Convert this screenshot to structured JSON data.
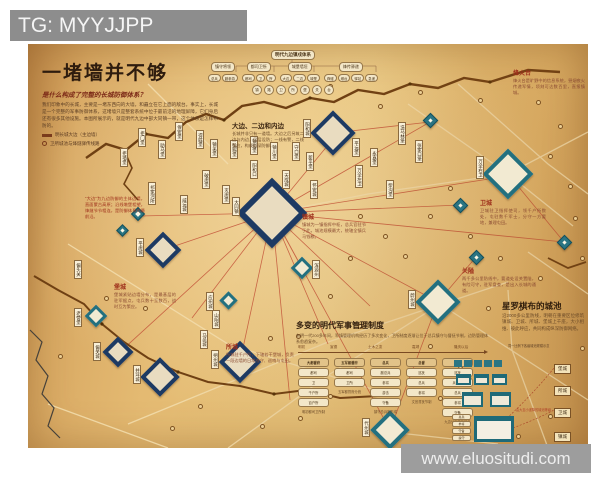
{
  "watermarks": {
    "top": "TG: MYYJJPP",
    "bottom": "www.eluositudi.com"
  },
  "header": {
    "title": "一堵墙并不够",
    "subtitle": "是什么构成了完整的长城防御体系？",
    "intro": "我们印象中的长城，主要是一堵东西向的大墙，和矗立在它上面的敌台。事实上，长城是一个完整的军事防御体系，这堵墙只是整套系统中位于最前沿的地理屏障，它们身后还有很多其他设施。本图所展示的，就是明代九边中部大同镇一带，这个体系是怎样布防的。",
    "legend": [
      {
        "icon": "wall",
        "label": "明长城大边（主边墙）"
      },
      {
        "icon": "beacon",
        "label": "卫所城池与烽燧驿传线路"
      }
    ]
  },
  "org": {
    "root": "明代九边镇戍体系",
    "groups": [
      {
        "label": "镇守将领",
        "leaves": [
          "总兵",
          "副参游"
        ]
      },
      {
        "label": "都司卫所",
        "leaves": [
          "都司",
          "卫",
          "所"
        ]
      },
      {
        "label": "城堡墙垣",
        "leaves": [
          "大边",
          "二边",
          "城堡"
        ]
      },
      {
        "label": "烽传驿递",
        "leaves": [
          "烽燧",
          "墩台",
          "驿站",
          "急递"
        ]
      }
    ],
    "circles": [
      "镇",
      "路",
      "卫",
      "所",
      "堡",
      "关",
      "台"
    ]
  },
  "annotations": [
    {
      "x": 57,
      "y": 152,
      "w": 60,
      "variant": "red-note",
      "title": "",
      "text": "“大边”为九边防御的主体边墙，直面蒙古高原；沿线墩堡相望，烽燧节节相连，是防御体系的最前沿。"
    },
    {
      "x": 204,
      "y": 76,
      "w": 72,
      "variant": "dark",
      "title": "大边、二边和内边",
      "text": "长城并非只有一道墙。大边之后另筑二边与内边，层层设防；一线有警，二线策应，构成纵深防御。"
    },
    {
      "x": 274,
      "y": 168,
      "w": 64,
      "variant": "red",
      "title": "镇城",
      "text": "镇城为一镇指挥中枢，总兵官驻节于此，城池规模最大，统辖全镇兵马钱粮。"
    },
    {
      "x": 452,
      "y": 154,
      "w": 66,
      "variant": "red",
      "title": "卫城",
      "text": "卫城驻卫指挥使司，领千户所数处，屯驻数千军士，分守一方要地，兼理屯田。"
    },
    {
      "x": 434,
      "y": 222,
      "w": 74,
      "variant": "red",
      "title": "关隘",
      "text": "两千多公里防线中，要道处设关置隘，有险可守，驻军盘查，是出入长城的通道。"
    },
    {
      "x": 86,
      "y": 238,
      "w": 62,
      "variant": "red",
      "title": "堡城",
      "text": "堡城紧贴边墙分布，是最基层的驻军据点，屯兵数十至数百，战时互为策应。"
    },
    {
      "x": 198,
      "y": 298,
      "w": 68,
      "variant": "red",
      "title": "所城",
      "text": "所城驻千户所，下辖若干堡城，负责一段边墙的日常戍守、巡哨与屯田。"
    },
    {
      "x": 474,
      "y": 256,
      "w": 82,
      "variant": "big",
      "title": "星罗棋布的城池",
      "text": "沿2000多公里防线，明朝在重要区位修筑镇城、卫城、所城、堡城上千座，大小相维、彼此呼应，共同构成纵深防御网络。"
    },
    {
      "x": 485,
      "y": 24,
      "w": 72,
      "variant": "red",
      "title": "烽火台",
      "text": "烽火台是旷野中的信息系统，昼烟夜火传递军情，顷刻可达数百里，直报镇城。"
    }
  ],
  "map": {
    "forts": [
      {
        "x": 244,
        "y": 169,
        "s": 50,
        "t": "zhen",
        "label": "大同镇",
        "lx": -40,
        "ly": -16
      },
      {
        "x": 305,
        "y": 89,
        "s": 32,
        "t": "zhen",
        "label": "阳和城",
        "lx": -30,
        "ly": -14
      },
      {
        "x": 135,
        "y": 206,
        "s": 26,
        "t": "zhen",
        "label": "平虏城",
        "lx": -27,
        "ly": -12
      },
      {
        "x": 212,
        "y": 318,
        "s": 30,
        "t": "zhen",
        "label": "朔州城",
        "lx": -29,
        "ly": -12
      },
      {
        "x": 132,
        "y": 333,
        "s": 28,
        "t": "zhen",
        "label": "井坪城",
        "lx": -27,
        "ly": -12
      },
      {
        "x": 90,
        "y": 308,
        "s": 22,
        "t": "zhen",
        "label": "偏关城",
        "lx": -25,
        "ly": -10
      },
      {
        "x": 480,
        "y": 130,
        "s": 36,
        "t": "wei",
        "label": "万全右卫",
        "lx": -32,
        "ly": -18
      },
      {
        "x": 410,
        "y": 258,
        "s": 32,
        "t": "wei",
        "label": "蔚州城",
        "lx": -30,
        "ly": -12
      },
      {
        "x": 362,
        "y": 386,
        "s": 28,
        "t": "wei",
        "label": "代州城",
        "lx": -28,
        "ly": -12
      },
      {
        "x": 274,
        "y": 224,
        "s": 16,
        "t": "wei",
        "label": "浑源州",
        "lx": 10,
        "ly": -8
      },
      {
        "x": 200,
        "y": 256,
        "s": 13,
        "t": "wei",
        "label": "应州城",
        "lx": -22,
        "ly": -8
      },
      {
        "x": 68,
        "y": 272,
        "s": 16,
        "t": "wei",
        "label": "老营堡",
        "lx": -22,
        "ly": -8
      },
      {
        "x": 432,
        "y": 161,
        "s": 11,
        "t": "small"
      },
      {
        "x": 536,
        "y": 198,
        "s": 11,
        "t": "small"
      },
      {
        "x": 448,
        "y": 213,
        "s": 11,
        "t": "small"
      },
      {
        "x": 402,
        "y": 76,
        "s": 11,
        "t": "small"
      },
      {
        "x": 110,
        "y": 170,
        "s": 10,
        "t": "small"
      },
      {
        "x": 94,
        "y": 186,
        "s": 9,
        "t": "small"
      }
    ],
    "fort_labels": [
      [
        92,
        104,
        "拒墙堡"
      ],
      [
        110,
        84,
        "拒门堡"
      ],
      [
        130,
        96,
        "助马堡"
      ],
      [
        147,
        78,
        "保安堡"
      ],
      [
        168,
        86,
        "得胜堡"
      ],
      [
        182,
        95,
        "镇羌堡"
      ],
      [
        202,
        96,
        "弘赐堡"
      ],
      [
        222,
        92,
        "镇边堡"
      ],
      [
        242,
        98,
        "镇川堡"
      ],
      [
        264,
        98,
        "守口堡"
      ],
      [
        278,
        108,
        "新平堡"
      ],
      [
        324,
        94,
        "平远堡"
      ],
      [
        342,
        104,
        "永嘉堡"
      ],
      [
        370,
        78,
        "洗马林堡"
      ],
      [
        387,
        96,
        "张家口堡"
      ],
      [
        174,
        126,
        "破虏堡"
      ],
      [
        194,
        141,
        "灭虏堡"
      ],
      [
        152,
        151,
        "威远城"
      ],
      [
        120,
        138,
        "祁家河所"
      ],
      [
        222,
        116,
        "阳和口"
      ],
      [
        254,
        126,
        "天成城"
      ],
      [
        282,
        136,
        "怀安城"
      ],
      [
        327,
        121,
        "万全左卫"
      ],
      [
        358,
        136,
        "柴沟堡"
      ],
      [
        172,
        286,
        "马邑城"
      ],
      [
        184,
        266,
        "山阴城"
      ],
      [
        46,
        216,
        "偏头关"
      ]
    ],
    "beacons": [
      [
        330,
        170
      ],
      [
        355,
        190
      ],
      [
        375,
        210
      ],
      [
        320,
        212
      ],
      [
        300,
        250
      ],
      [
        330,
        280
      ],
      [
        268,
        290
      ],
      [
        240,
        292
      ],
      [
        400,
        300
      ],
      [
        430,
        322
      ],
      [
        458,
        262
      ],
      [
        490,
        262
      ],
      [
        510,
        232
      ],
      [
        440,
        190
      ],
      [
        470,
        212
      ],
      [
        400,
        170
      ],
      [
        420,
        142
      ],
      [
        520,
        110
      ],
      [
        540,
        140
      ],
      [
        530,
        80
      ],
      [
        508,
        56
      ],
      [
        450,
        54
      ],
      [
        390,
        46
      ],
      [
        360,
        356
      ],
      [
        300,
        350
      ],
      [
        270,
        372
      ],
      [
        232,
        380
      ],
      [
        410,
        352
      ],
      [
        488,
        390
      ],
      [
        170,
        360
      ],
      [
        142,
        382
      ],
      [
        30,
        310
      ],
      [
        115,
        262
      ],
      [
        76,
        252
      ],
      [
        545,
        172
      ],
      [
        552,
        212
      ],
      [
        350,
        60
      ],
      [
        300,
        40
      ],
      [
        552,
        302
      ],
      [
        520,
        370
      ]
    ]
  },
  "timeline": {
    "heading": "多变的明代军事管理制度",
    "para": "有明一代200多年间，军镇管理机构经历了多次变化，卫所制度逐渐让位于总兵镇守与督抚节制，边防管理体系愈趋复杂。",
    "eras": [
      "明初",
      "宣德",
      "土木之变",
      "嘉靖",
      "隆庆以后"
    ],
    "era_x": [
      2,
      34,
      72,
      116,
      158
    ],
    "columns": [
      {
        "pills": [
          "大都督府",
          "都司",
          "卫",
          "千户所",
          "百户所"
        ],
        "caption": "明初都司卫所制"
      },
      {
        "pills": [
          "五军都督府",
          "都司",
          "卫所"
        ],
        "caption": "五军都督府分统"
      },
      {
        "pills": [
          "总兵",
          "副总兵",
          "参将",
          "游击",
          "守备"
        ],
        "caption": "镇守总兵制形成"
      },
      {
        "pills": [
          "总督",
          "巡抚",
          "总兵",
          "参将"
        ],
        "caption": "文官督抚节制"
      },
      {
        "pills": [
          "总督",
          "巡抚",
          "兵备道",
          "总兵",
          "参将",
          "守备"
        ],
        "caption": "九边分守体系确立"
      }
    ]
  },
  "hierarchy": {
    "note": "同一比例下各级城池规模示意",
    "red_note": "由大至小递降的城池等级",
    "labels": [
      "堡城",
      "所城",
      "卫城",
      "镇城"
    ],
    "label_y": [
      20,
      42,
      64,
      88
    ],
    "pills": [
      "总兵",
      "参将",
      "守备",
      "操守"
    ],
    "rows": [
      {
        "y": 16,
        "w": 8,
        "h": 7,
        "xs": [
          2,
          12,
          22,
          32,
          42
        ],
        "cls": ""
      },
      {
        "y": 30,
        "w": 15,
        "h": 11,
        "xs": [
          4,
          22,
          40
        ],
        "cls": "m"
      },
      {
        "y": 48,
        "w": 21,
        "h": 15,
        "xs": [
          10,
          38
        ],
        "cls": "m"
      }
    ],
    "big": {
      "x": 22,
      "y": 72,
      "w": 40,
      "h": 26
    }
  }
}
